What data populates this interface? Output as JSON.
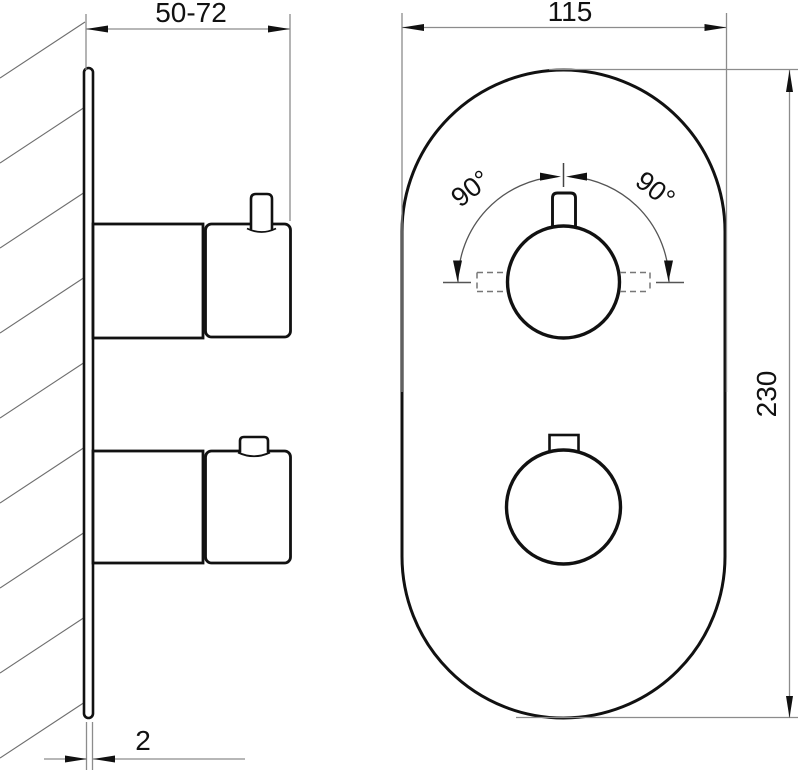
{
  "drawing": {
    "type": "technical-dimension-drawing",
    "views": {
      "side_view_present": true,
      "front_view_present": true
    }
  },
  "labels": {
    "depth_range": "50-72",
    "faceplate_width": "115",
    "faceplate_height": "230",
    "plate_thickness": "2",
    "rotation_left": "90°",
    "rotation_right": "90°"
  },
  "colors": {
    "background": "#ffffff",
    "outline": "#111111",
    "dimension_line": "#8c8c8c",
    "hatch_line": "#6e6e6e",
    "dashed_line": "#777777",
    "text": "#111111"
  }
}
